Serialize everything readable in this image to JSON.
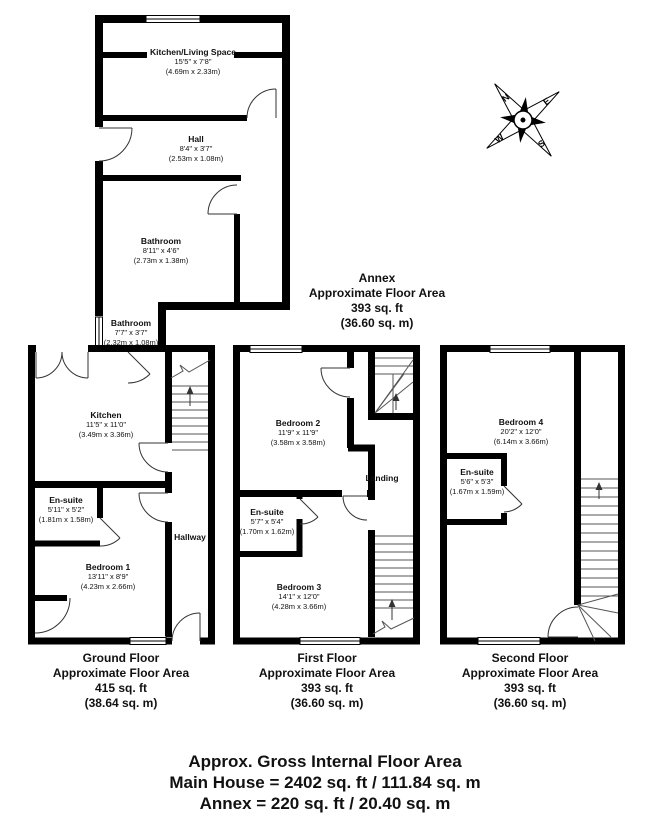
{
  "page": {
    "background": "#ffffff",
    "line_color": "#000000"
  },
  "compass": {
    "n": "N",
    "e": "E",
    "s": "S",
    "w": "W"
  },
  "annex": {
    "rooms": {
      "kitchen_living": {
        "name": "Kitchen/Living Space",
        "dims_ft": "15'5\" x 7'8\"",
        "dims_m": "(4.69m x 2.33m)"
      },
      "hall": {
        "name": "Hall",
        "dims_ft": "8'4\" x 3'7\"",
        "dims_m": "(2.53m x 1.08m)"
      },
      "bathroom": {
        "name": "Bathroom",
        "dims_ft": "8'11\" x 4'6\"",
        "dims_m": "(2.73m x 1.38m)"
      },
      "link_bathroom": {
        "name": "Bathroom",
        "dims_ft": "7'7\" x 3'7\"",
        "dims_m": "(2.32m x 1.08m)"
      }
    },
    "caption": {
      "title": "Annex",
      "line2": "Approximate Floor Area",
      "line3": "393 sq. ft",
      "line4": "(36.60 sq. m)"
    }
  },
  "ground": {
    "rooms": {
      "kitchen": {
        "name": "Kitchen",
        "dims_ft": "11'5\" x 11'0\"",
        "dims_m": "(3.49m x 3.36m)"
      },
      "ensuite": {
        "name": "En-suite",
        "dims_ft": "5'11\" x 5'2\"",
        "dims_m": "(1.81m x 1.58m)"
      },
      "bedroom1": {
        "name": "Bedroom 1",
        "dims_ft": "13'11\" x 8'9\"",
        "dims_m": "(4.23m x 2.66m)"
      },
      "hallway": {
        "name": "Hallway"
      }
    },
    "caption": {
      "title": "Ground Floor",
      "line2": "Approximate Floor Area",
      "line3": "415 sq. ft",
      "line4": "(38.64 sq. m)"
    }
  },
  "first": {
    "rooms": {
      "bedroom2": {
        "name": "Bedroom 2",
        "dims_ft": "11'9\" x 11'9\"",
        "dims_m": "(3.58m x 3.58m)"
      },
      "landing": {
        "name": "Landing"
      },
      "ensuite": {
        "name": "En-suite",
        "dims_ft": "5'7\" x 5'4\"",
        "dims_m": "(1.70m x 1.62m)"
      },
      "bedroom3": {
        "name": "Bedroom 3",
        "dims_ft": "14'1\" x 12'0\"",
        "dims_m": "(4.28m x 3.66m)"
      }
    },
    "caption": {
      "title": "First Floor",
      "line2": "Approximate Floor Area",
      "line3": "393 sq. ft",
      "line4": "(36.60 sq. m)"
    }
  },
  "second": {
    "rooms": {
      "bedroom4": {
        "name": "Bedroom 4",
        "dims_ft": "20'2\" x 12'0\"",
        "dims_m": "(6.14m x 3.66m)"
      },
      "ensuite": {
        "name": "En-suite",
        "dims_ft": "5'6\" x 5'3\"",
        "dims_m": "(1.67m x 1.59m)"
      }
    },
    "caption": {
      "title": "Second Floor",
      "line2": "Approximate Floor Area",
      "line3": "393 sq. ft",
      "line4": "(36.60 sq. m)"
    }
  },
  "summary": {
    "line1": "Approx. Gross Internal Floor Area",
    "line2": "Main House = 2402 sq. ft / 111.84 sq. m",
    "line3": "Annex = 220 sq. ft / 20.40 sq. m"
  }
}
